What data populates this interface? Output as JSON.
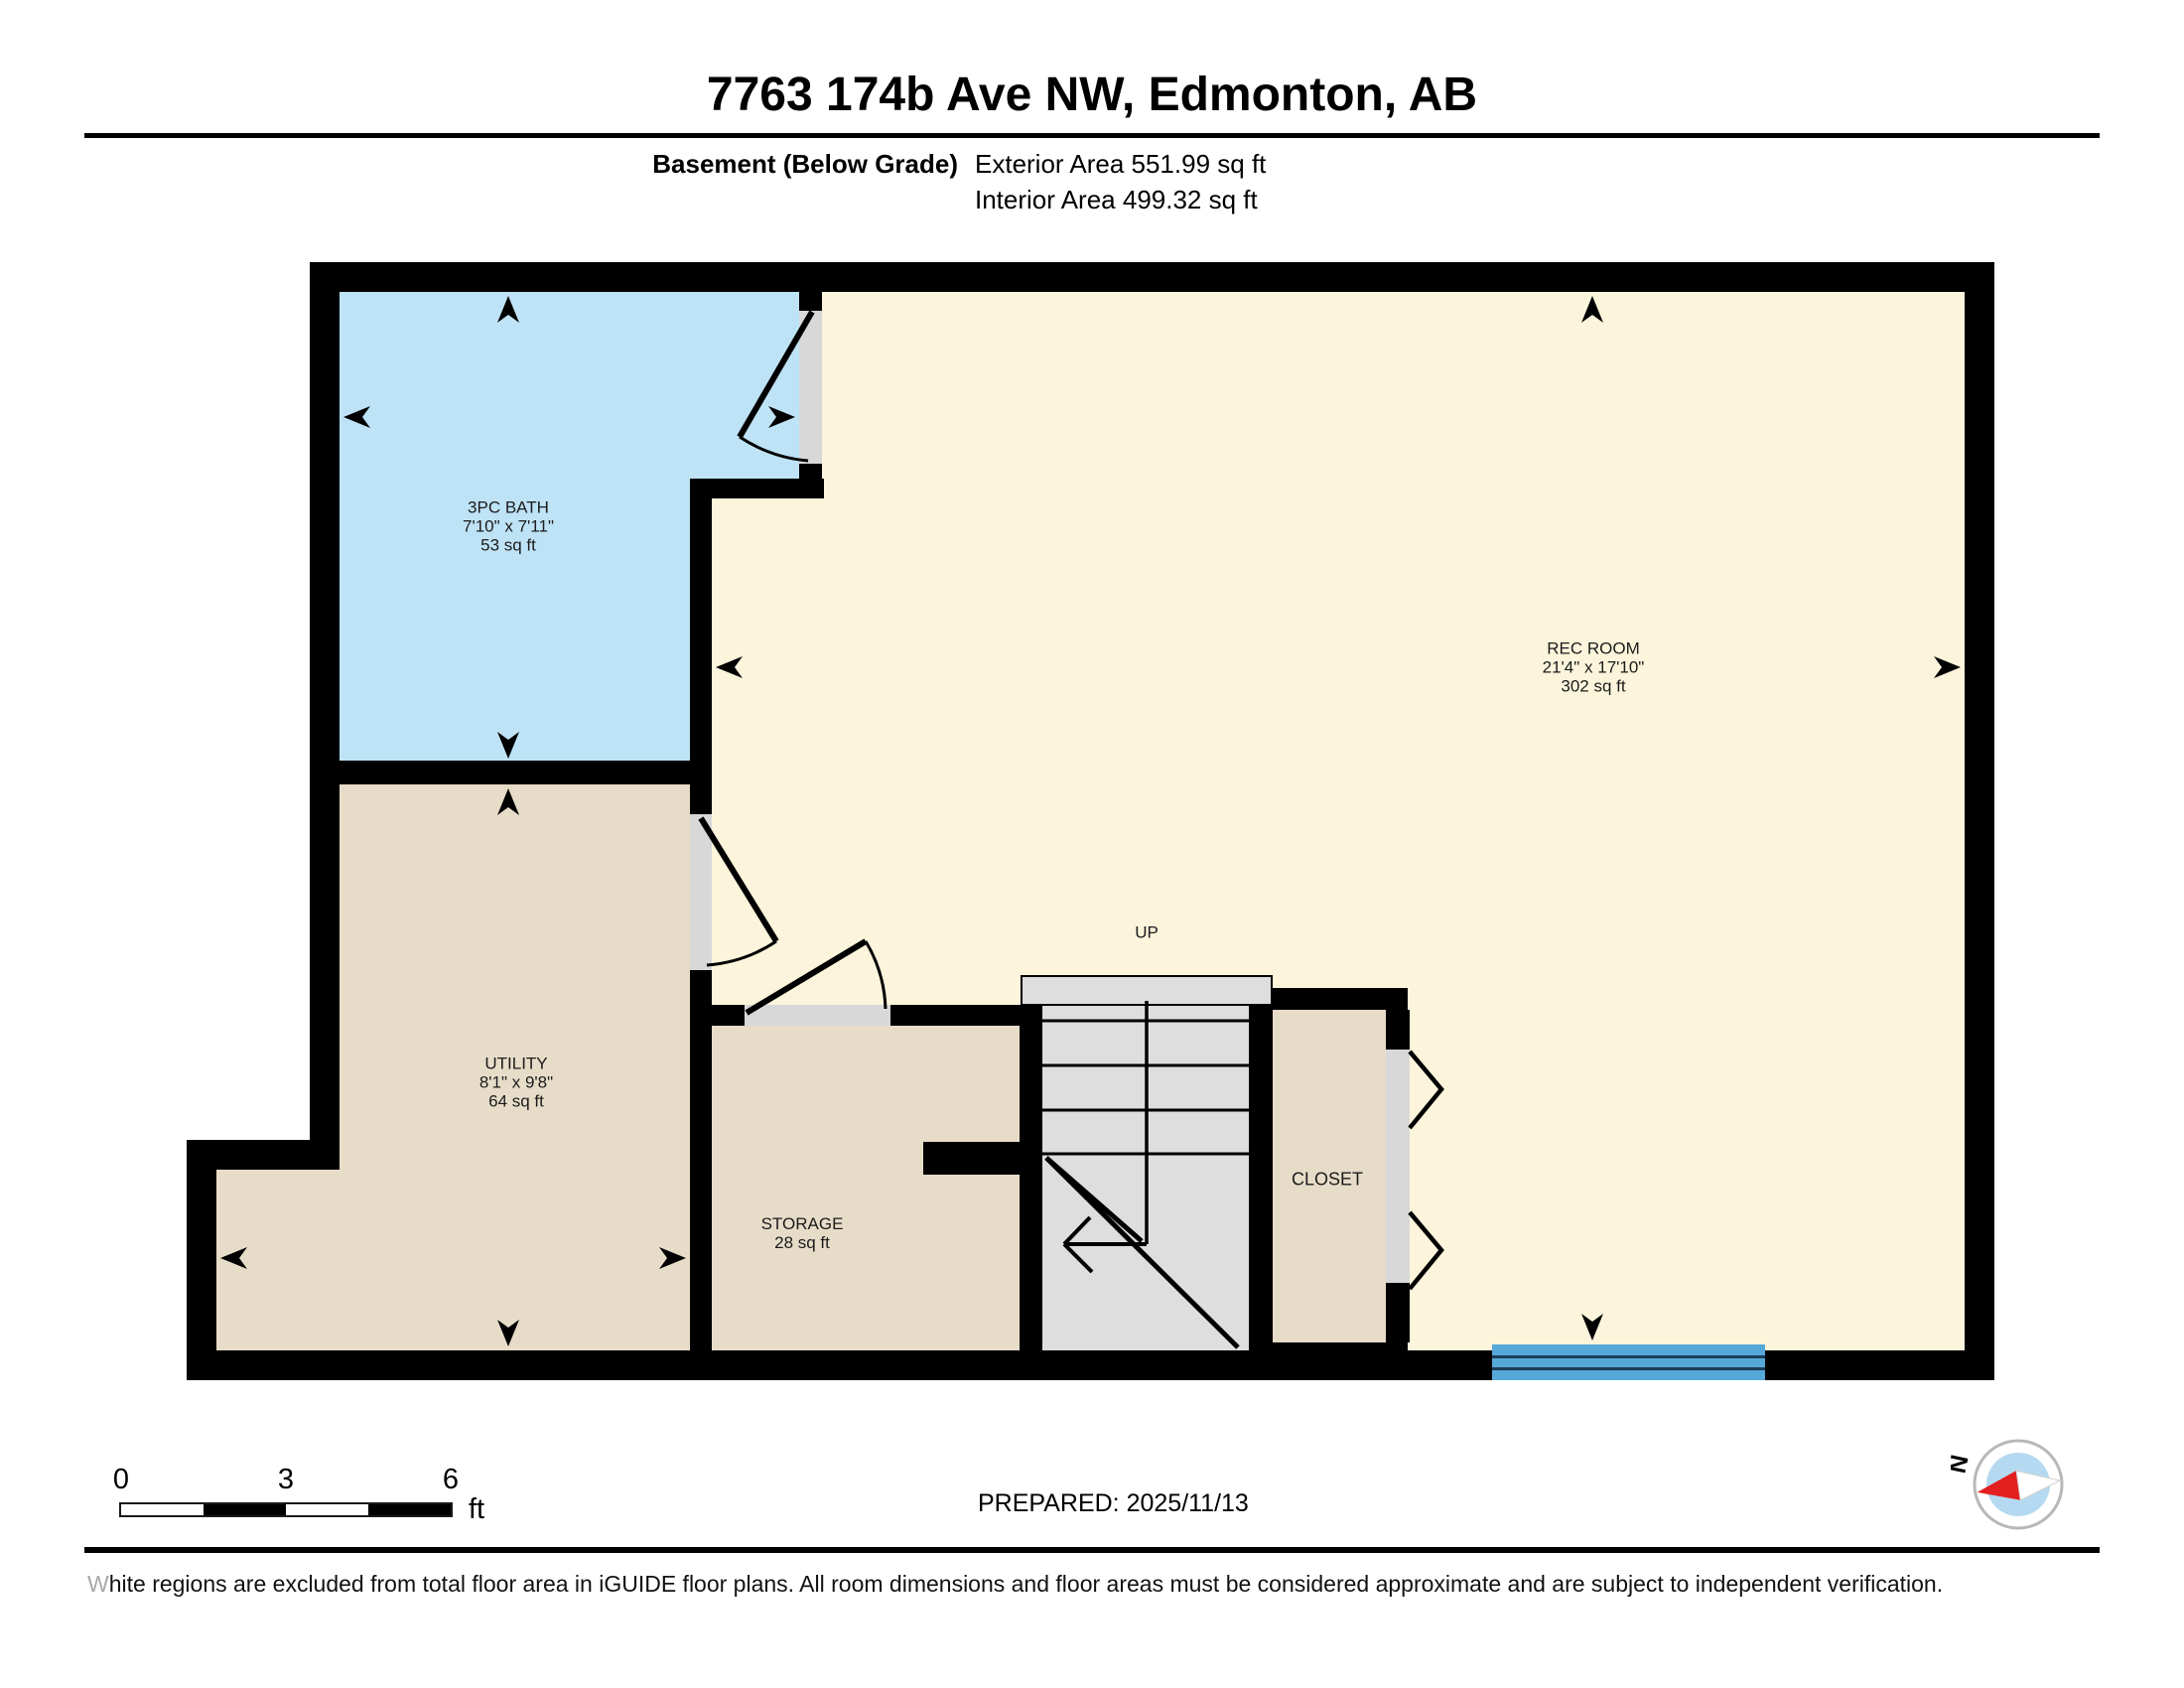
{
  "header": {
    "title": "7763 174b Ave NW, Edmonton, AB",
    "floor_label": "Basement (Below Grade)",
    "exterior_area": "Exterior Area 551.99 sq ft",
    "interior_area": "Interior Area 499.32 sq ft"
  },
  "rooms": {
    "bath": {
      "name": "3PC BATH",
      "dims": "7'10\" x 7'11\"",
      "area": "53 sq ft"
    },
    "rec_room": {
      "name": "REC ROOM",
      "dims": "21'4\" x 17'10\"",
      "area": "302 sq ft"
    },
    "utility": {
      "name": "UTILITY",
      "dims": "8'1\" x 9'8\"",
      "area": "64 sq ft"
    },
    "storage": {
      "name": "STORAGE",
      "area": "28 sq ft"
    },
    "closet": {
      "name": "CLOSET"
    },
    "stairs": {
      "direction_label": "UP"
    }
  },
  "scale_bar": {
    "tick_start": "0",
    "tick_mid": "3",
    "tick_end": "6",
    "unit": "ft"
  },
  "compass": {
    "north_label": "N"
  },
  "footer": {
    "prepared": "PREPARED: 2025/11/13",
    "disclaimer_lead": "W",
    "disclaimer_rest": "hite regions are excluded from total floor area in iGUIDE floor plans. All room dimensions and floor areas must be considered approximate and are subject to independent verification."
  },
  "colors": {
    "highlight_room": "#bfe3f6",
    "neutral_room": "#e6dcc8",
    "floor_base": "#fcf5dc",
    "stairs_gray": "#dedede",
    "window_blue": "#55a8d8",
    "wall_black": "#000000",
    "compass_needle_red": "#e3201f"
  }
}
